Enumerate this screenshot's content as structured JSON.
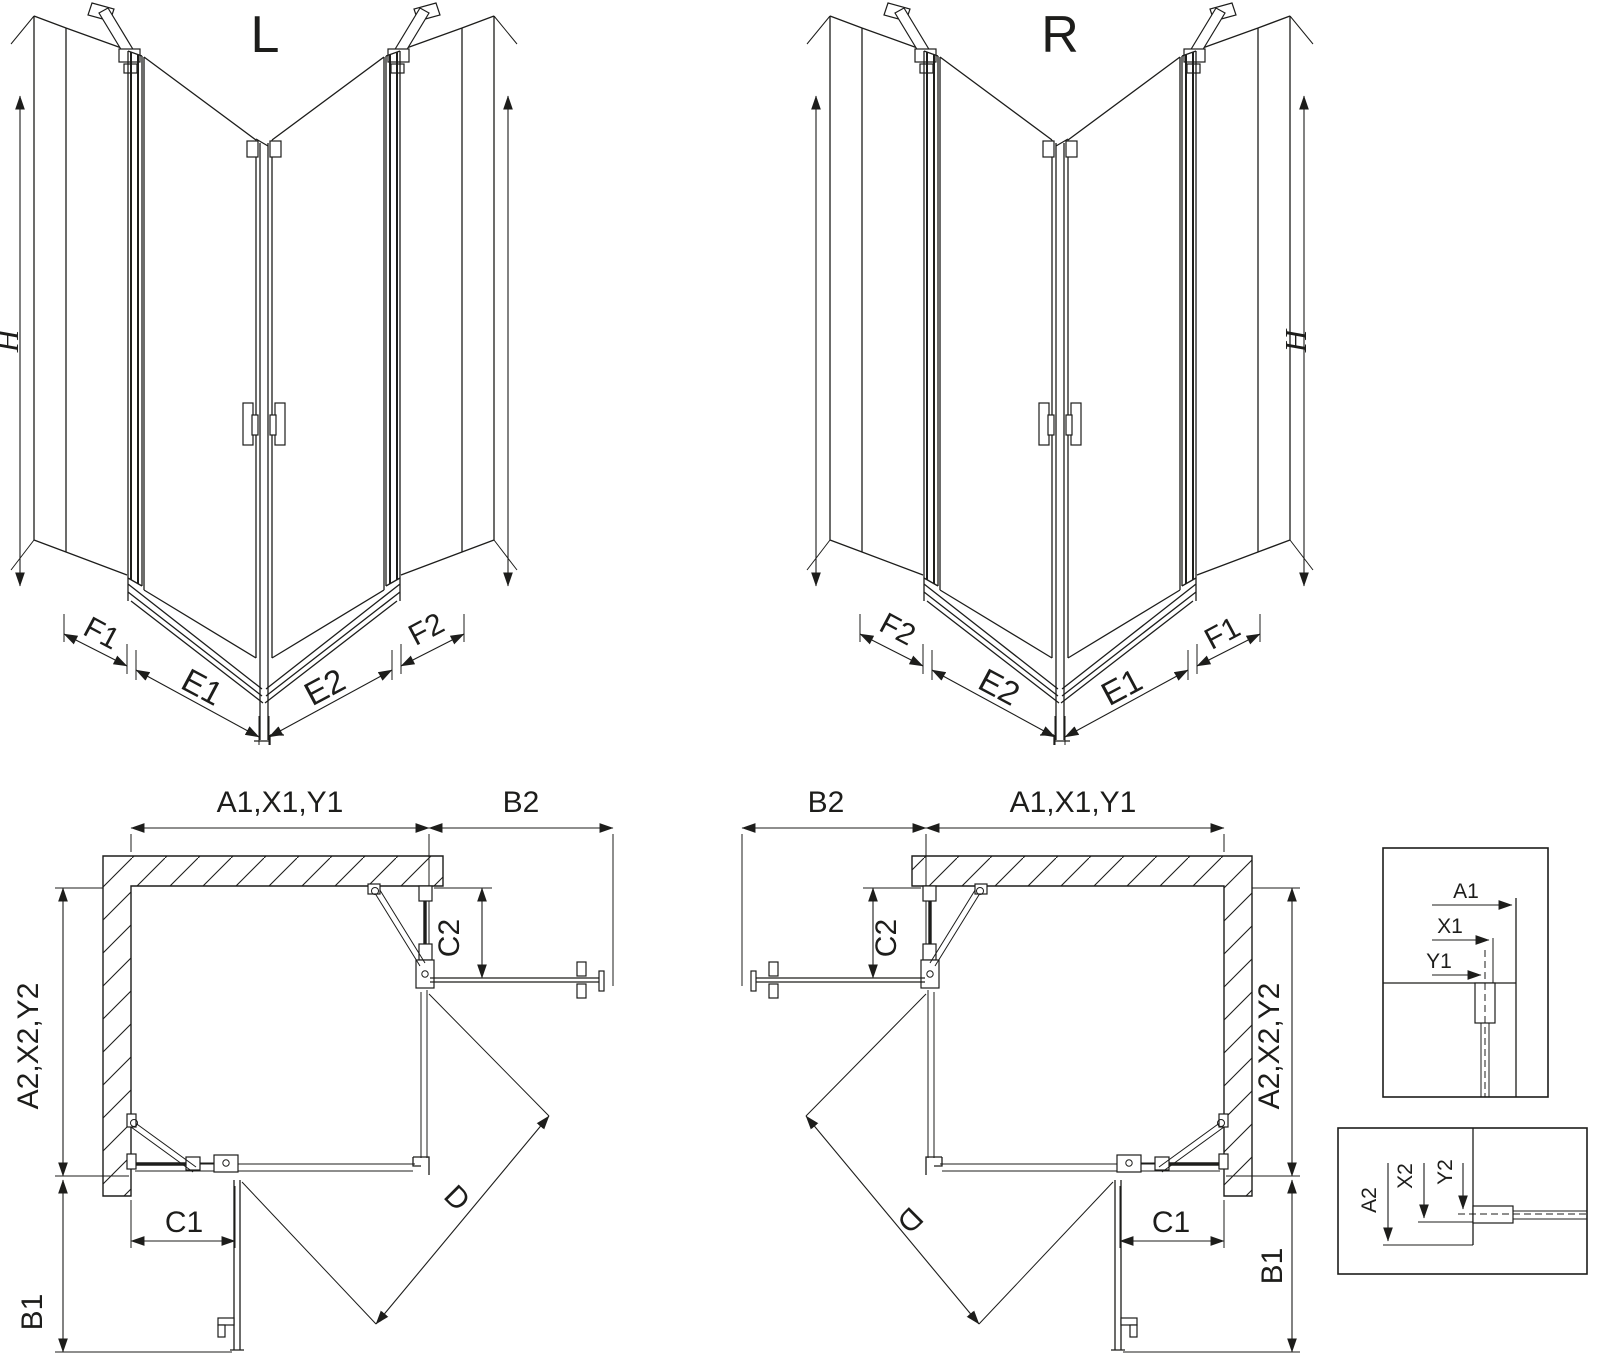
{
  "colors": {
    "line": "#1d1d1b",
    "background": "#ffffff"
  },
  "iso_left": {
    "title": "L",
    "height_label": "H",
    "panel_labels": {
      "f1": "F1",
      "e1": "E1",
      "e2": "E2",
      "f2": "F2"
    }
  },
  "iso_right": {
    "title": "R",
    "height_label": "H",
    "panel_labels": {
      "f1": "F1",
      "e1": "E1",
      "e2": "E2",
      "f2": "F2"
    }
  },
  "plan_left": {
    "width_label": "A1,X1,Y1",
    "side_door_label": "B2",
    "depth_label": "A2,X2,Y2",
    "fixed_side_label": "C2",
    "fixed_bottom_label": "C1",
    "front_door_label": "B1",
    "diagonal_label": "D"
  },
  "plan_right": {
    "width_label": "A1,X1,Y1",
    "side_door_label": "B2",
    "depth_label": "A2,X2,Y2",
    "fixed_side_label": "C2",
    "fixed_bottom_label": "C1",
    "front_door_label": "B1",
    "diagonal_label": "D"
  },
  "detail_top": {
    "labels": {
      "a1": "A1",
      "x1": "X1",
      "y1": "Y1"
    }
  },
  "detail_bottom": {
    "labels": {
      "a2": "A2",
      "x2": "X2",
      "y2": "Y2"
    }
  }
}
